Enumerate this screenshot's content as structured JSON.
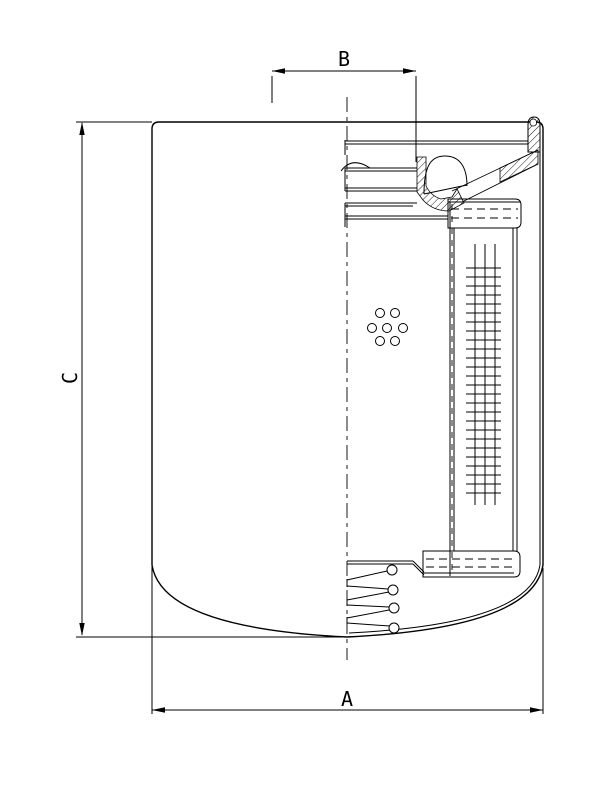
{
  "page": {
    "background": "#ffffff",
    "line_color": "#000000"
  },
  "dimension_labels": {
    "overall_width": "A",
    "thread_span": "B",
    "overall_height": "C"
  }
}
